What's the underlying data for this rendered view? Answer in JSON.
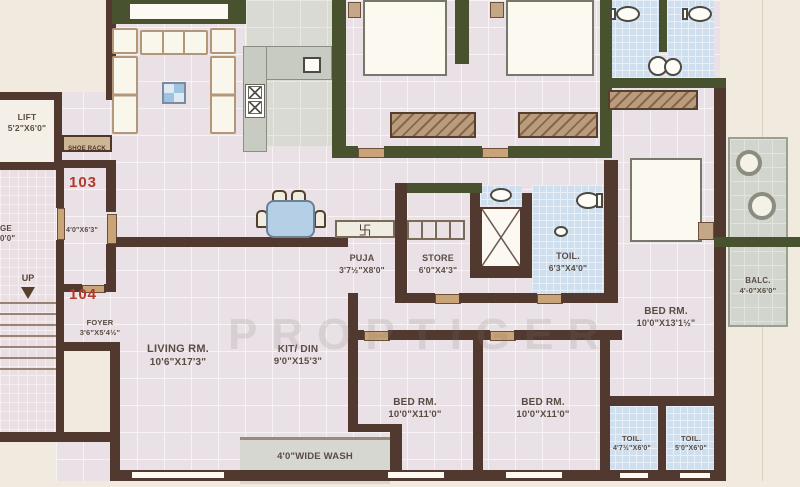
{
  "watermark": "PROPTIGER",
  "units": {
    "upper": "103",
    "lower": "104"
  },
  "rooms": {
    "lift": {
      "name": "LIFT",
      "dims": "5'2\"X6'0\""
    },
    "shoe_rack": {
      "name": "SHOE RACK"
    },
    "passage_cut": {
      "name": "GE",
      "dims": "0'0\""
    },
    "stair": {
      "up_label": "UP"
    },
    "entry": {
      "dims": "4'0\"X6'3\""
    },
    "foyer": {
      "name": "FOYER",
      "dims": "3'6\"X5'4½\""
    },
    "living": {
      "name": "LIVING RM.",
      "dims": "10'6\"X17'3\""
    },
    "kitdin": {
      "name": "KIT/ DIN",
      "dims": "9'0\"X15'3\""
    },
    "puja": {
      "name": "PUJA",
      "dims": "3'7½\"X8'0\""
    },
    "store": {
      "name": "STORE",
      "dims": "6'0\"X4'3\""
    },
    "toilet_mid": {
      "name": "TOIL.",
      "dims": "6'3\"X4'0\""
    },
    "bed_master": {
      "name": "BED RM.",
      "dims": "10'0\"X13'1½\""
    },
    "balcony": {
      "name": "BALC.",
      "dims": "4'-0\"X6'0\""
    },
    "bed_left": {
      "name": "BED RM.",
      "dims": "10'0\"X11'0\""
    },
    "bed_right": {
      "name": "BED RM.",
      "dims": "10'0\"X11'0\""
    },
    "toilet_b1": {
      "name": "TOIL.",
      "dims": "4'7½\"X6'0\""
    },
    "toilet_b2": {
      "name": "TOIL.",
      "dims": "5'0\"X6'0\""
    },
    "wash": {
      "name": "4'0\"WIDE WASH"
    }
  },
  "symbols": {
    "swastika": "卐"
  },
  "colors": {
    "wall_brown": "#523930",
    "wall_olive": "#49522f",
    "floor_pink": "#e9e1e5",
    "tile_blue": "#cfdfee",
    "unit_red": "#b5392b"
  }
}
